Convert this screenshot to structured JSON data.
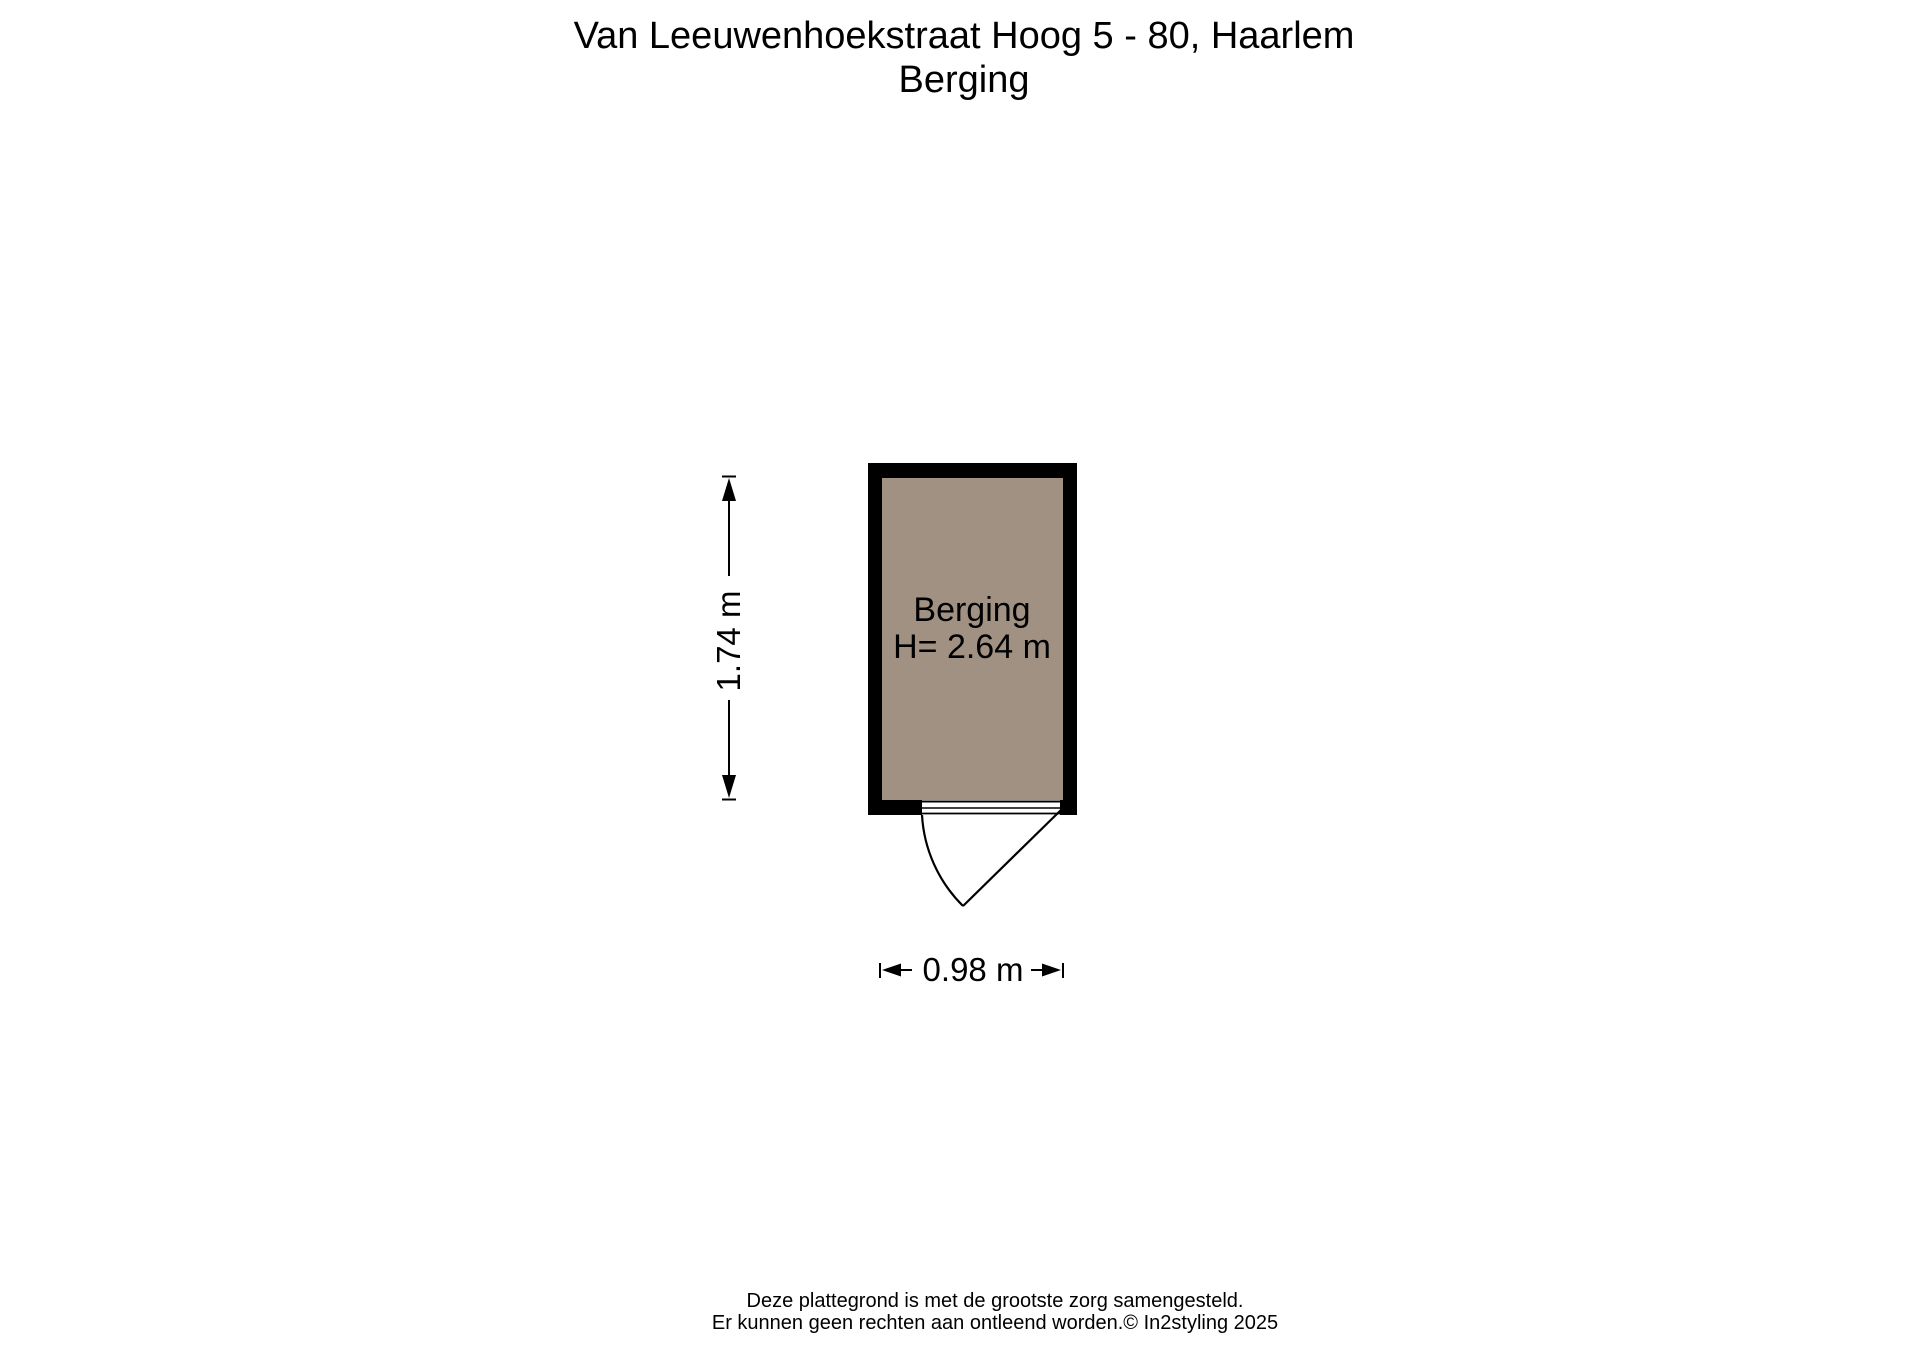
{
  "title": {
    "line1": "Van Leeuwenhoekstraat Hoog 5 - 80, Haarlem",
    "line2": "Berging"
  },
  "room": {
    "name": "Berging",
    "ceiling_height": "H= 2.64 m"
  },
  "dimensions": {
    "height": "1.74 m",
    "width": "0.98 m"
  },
  "footer": {
    "line1": "Deze plattegrond is met de grootste zorg samengesteld.",
    "line2": "Er kunnen geen rechten aan ontleend worden.© In2styling 2025"
  },
  "colors": {
    "wall": "#000000",
    "floor": "#a09183",
    "threshold": "#ffffff",
    "line": "#000000",
    "background": "#ffffff"
  }
}
